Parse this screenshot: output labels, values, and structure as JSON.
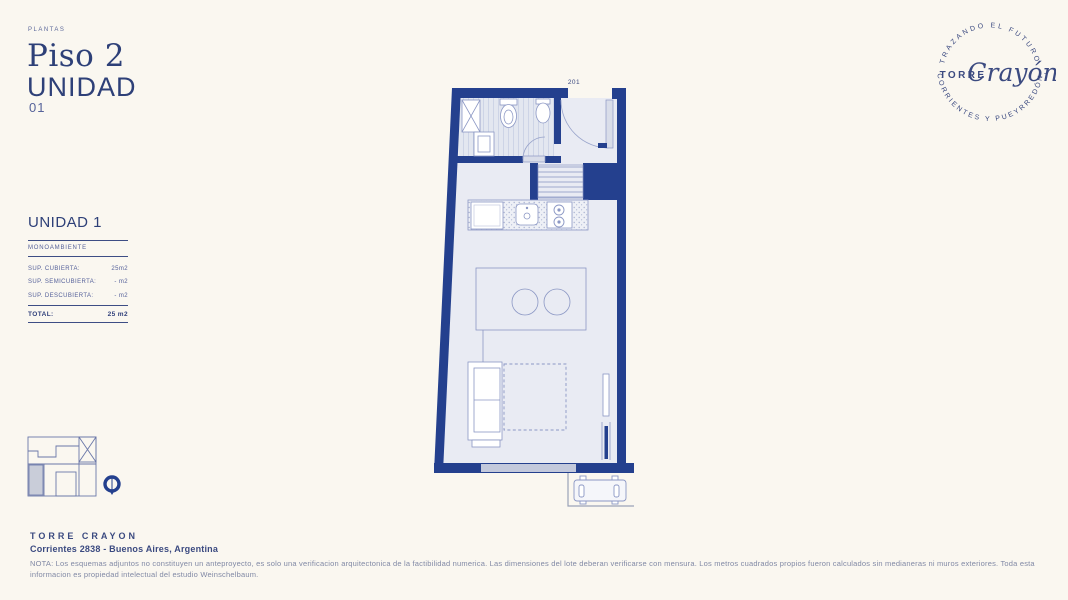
{
  "colors": {
    "background": "#faf7f0",
    "wall_navy": "#24408e",
    "text_navy": "#2e4078",
    "floor": "#e9ebf3",
    "line_blue": "#8b97c4"
  },
  "header": {
    "eyebrow": "PLANTAS",
    "floor_title": "Piso 2",
    "unit_word": "UNIDAD",
    "unit_number": "01"
  },
  "logo": {
    "top_arc": "TRAZANDO EL FUTURO",
    "name_left": "TORRE",
    "name_script": "Crayón",
    "trailing_mark": "·",
    "bottom_arc": "CORRIENTES Y PUEYRREDÓN"
  },
  "unit_panel": {
    "title": "UNIDAD 1",
    "subtitle": "MONOAMBIENTE",
    "rows": [
      {
        "label": "SUP. CUBIERTA:",
        "value": "25m2"
      },
      {
        "label": "SUP. SEMICUBIERTA:",
        "value": "- m2"
      },
      {
        "label": "SUP. DESCUBIERTA:",
        "value": "- m2"
      }
    ],
    "total_label": "TOTAL:",
    "total_value": "25 m2"
  },
  "plan": {
    "unit_door_label": "201"
  },
  "footer": {
    "brand": "TORRE CRAYON",
    "address": "Corrientes 2838 - Buenos Aires, Argentina",
    "note": "NOTA: Los esquemas adjuntos no constituyen un anteproyecto, es solo una verificacion arquitectonica de la factibilidad numerica. Las dimensiones del lote deberan verificarse con mensura. Los metros cuadrados propios fueron calculados sin medianeras ni muros exteriores. Toda esta informacion es propiedad intelectual del estudio Weinschelbaum."
  }
}
